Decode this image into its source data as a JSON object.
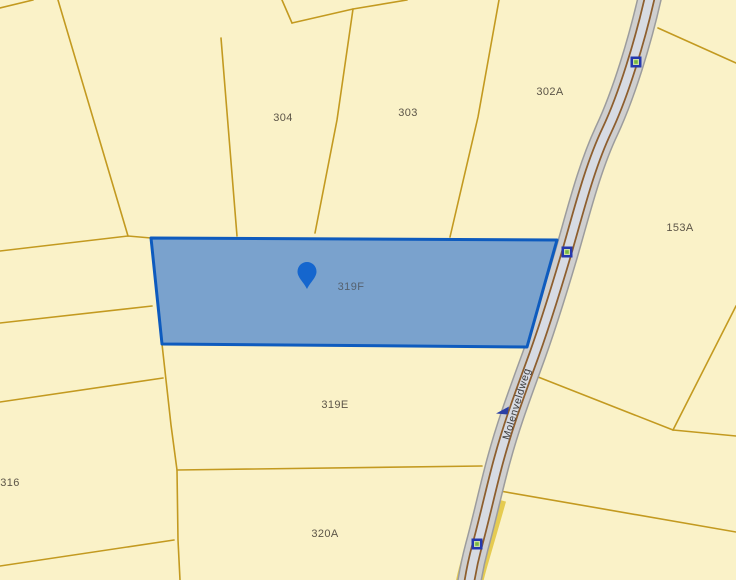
{
  "map": {
    "type": "cadastral-parcel-map",
    "selected_parcel": "319F",
    "road": {
      "name": "Molenveldweg"
    },
    "parcels": [
      {
        "label": "304"
      },
      {
        "label": "303"
      },
      {
        "label": "302A"
      },
      {
        "label": "153A"
      },
      {
        "label": "319F"
      },
      {
        "label": "319E"
      },
      {
        "label": "320A"
      },
      {
        "label": "316"
      }
    ],
    "road_markers": {
      "count": 3,
      "icon": "boundary-point-marker"
    },
    "icons": {
      "pin": "map-pin"
    },
    "colors": {
      "parcel_fill": "#FAF2C8",
      "parcel_border": "#C39A20",
      "selected_fill": "#7AA2CD",
      "selected_border": "#0E5BBE",
      "pin": "#1566CE",
      "road_casing": "#CFCFCF",
      "road_center": "#D7DBE3",
      "road_edge_line": "#8D5E2E",
      "marker_border": "#2438AE",
      "marker_green": "#79B93F",
      "label_text": "#5C5548",
      "road_label_text": "#3C3C3C"
    }
  }
}
